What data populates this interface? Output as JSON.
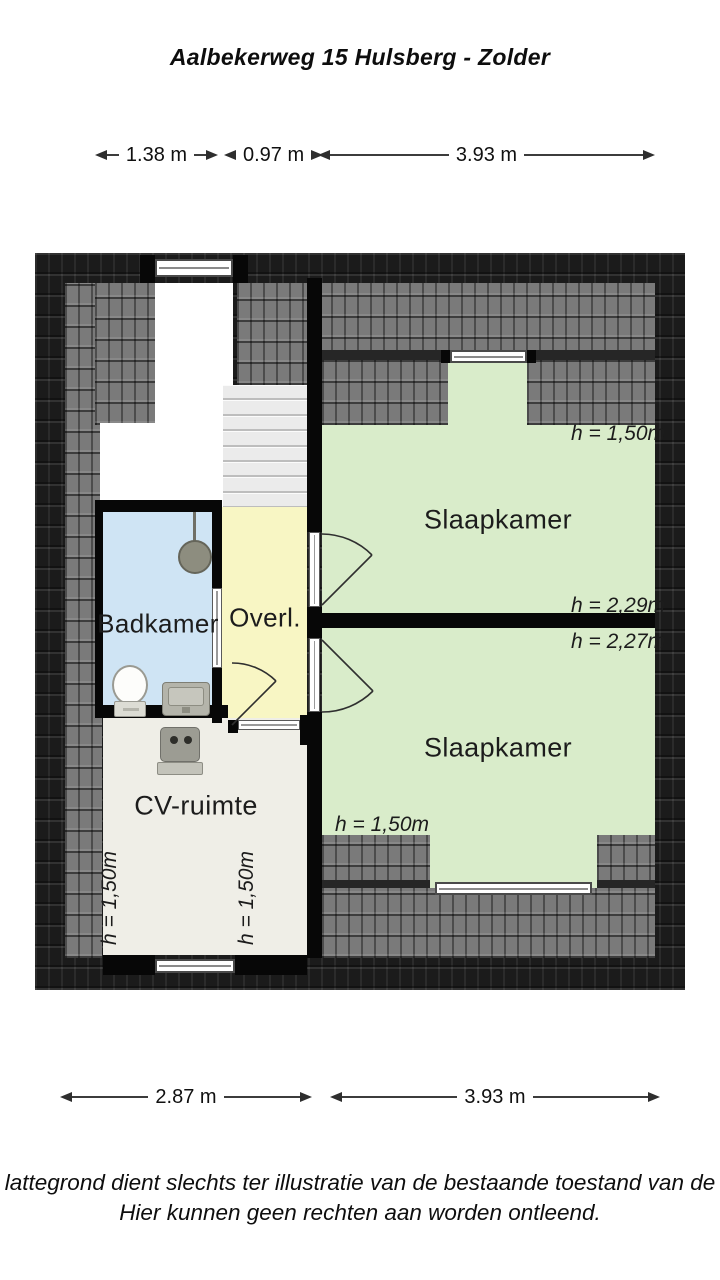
{
  "title": "Aalbekerweg 15 Hulsberg - Zolder",
  "dimensions": {
    "top": [
      {
        "value": "1.38 m"
      },
      {
        "value": "0.97 m"
      },
      {
        "value": "3.93 m"
      }
    ],
    "bottom": [
      {
        "value": "2.87 m"
      },
      {
        "value": "3.93 m"
      }
    ]
  },
  "floor_plan": {
    "rooms": {
      "badkamer": {
        "label": "Badkamer"
      },
      "overloop": {
        "label": "Overl."
      },
      "slaapkamer_1": {
        "label": "Slaapkamer",
        "h_top": "h = 1,50m",
        "h_bottom": "h = 2,29m"
      },
      "slaapkamer_2": {
        "label": "Slaapkamer",
        "h_top": "h = 2,27m",
        "h_left": "h = 1,50m"
      },
      "cv_ruimte": {
        "label": "CV-ruimte",
        "h_left": "h = 1,50m",
        "h_right": "h = 1,50m"
      }
    },
    "fixtures": {
      "shower": "shower-head",
      "toilet": "toilet",
      "sink": "sink",
      "boiler": "cv-boiler"
    }
  },
  "disclaimer": {
    "line1": "lattegrond dient slechts ter illustratie van de bestaande toestand van de",
    "line2": "Hier kunnen geen rechten aan worden ontleend."
  },
  "colors": {
    "room_green": "#d9ecca",
    "room_yellow": "#f8f6c4",
    "room_blue": "#cfe4f4",
    "room_offwhite": "#efeee7",
    "roof_light": "#7a7a7a",
    "roof_dark": "#1b1b1b",
    "wall": "#070707",
    "dim_line": "#3c3c3c"
  }
}
